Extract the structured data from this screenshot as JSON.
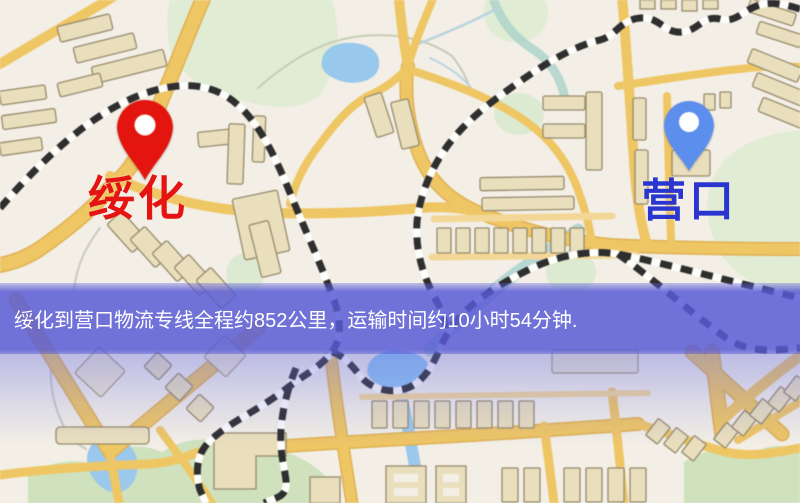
{
  "banner": {
    "text": "绥化到营口物流专线全程约852公里，运输时间约10小时54分钟.",
    "distance": "852公里",
    "duration": "10小时54分钟"
  },
  "markers": {
    "origin": {
      "label": "绥化",
      "icon": "map-pin",
      "pin_color": "#e8140c",
      "label_color": "#e31412"
    },
    "destination": {
      "label": "营口",
      "icon": "map-pin",
      "pin_color": "#5b8ef0",
      "label_color": "#2a36cf"
    }
  },
  "colors": {
    "map-bg": "#f3efe6",
    "banner-bg": "#585ad6",
    "road": "#f0c661",
    "rail": "#2e2e2e",
    "park": "#cfe2bc",
    "water": "#98c8ee",
    "origin-pin": "#e8140c",
    "origin-label": "#e31412",
    "dest-pin": "#5b8ef0",
    "dest-label": "#2a36cf"
  }
}
